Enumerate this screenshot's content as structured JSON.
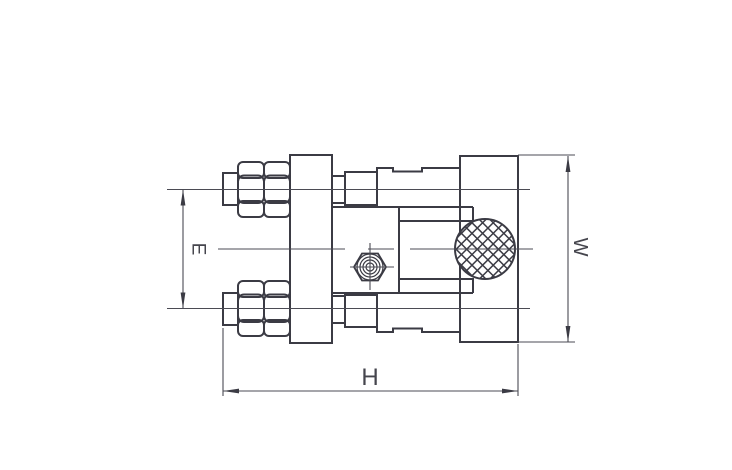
{
  "canvas": {
    "width": 732,
    "height": 470,
    "background_color": "#ffffff"
  },
  "style": {
    "outline_color": "#3b3b44",
    "thin_line_color": "#4b4b54",
    "label_color": "#45454d"
  },
  "dimensions": {
    "e": {
      "label": "E"
    },
    "h": {
      "label": "H"
    },
    "w": {
      "label": "W"
    }
  },
  "components": [
    "hex-bolt-with-locknuts-top",
    "hex-bolt-with-locknuts-bottom",
    "flange-plate",
    "adapter-body",
    "hex-socket-screw-front-view",
    "knurled-knob",
    "mounting-block"
  ]
}
